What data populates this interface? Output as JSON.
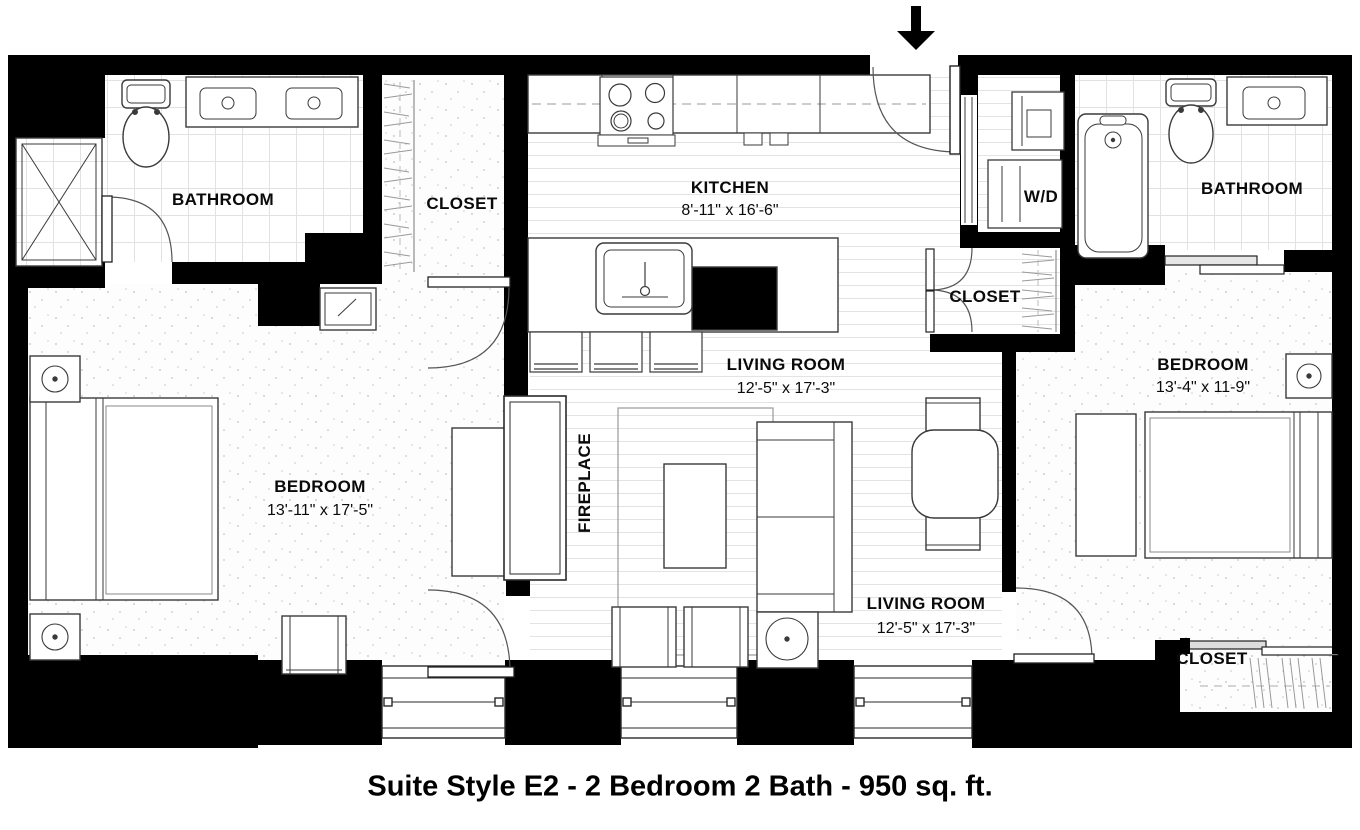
{
  "title": "Suite Style E2 - 2 Bedroom 2 Bath - 950 sq. ft.",
  "rooms": {
    "bathroom_left": {
      "label": "BATHROOM"
    },
    "closet_left": {
      "label": "CLOSET"
    },
    "kitchen": {
      "label": "KITCHEN",
      "dims": "8'-11\" x 16'-6\""
    },
    "wd": {
      "label": "W/D"
    },
    "closet_middle": {
      "label": "CLOSET"
    },
    "bathroom_right": {
      "label": "BATHROOM"
    },
    "living_room_upper": {
      "label": "LIVING ROOM",
      "dims": "12'-5\" x 17'-3\""
    },
    "bedroom_right": {
      "label": "BEDROOM",
      "dims": "13'-4\" x 11-9\""
    },
    "bedroom_left": {
      "label": "BEDROOM",
      "dims": "13'-11\" x 17'-5\""
    },
    "fireplace": {
      "label": "FIREPLACE"
    },
    "living_room_lower": {
      "label": "LIVING ROOM",
      "dims": "12'-5\" x 17'-3\""
    },
    "closet_bottom_right": {
      "label": "CLOSET"
    }
  },
  "colors": {
    "wall": "#000000",
    "line": "#3a3a3a",
    "floor_line": "#e3e3e3"
  }
}
